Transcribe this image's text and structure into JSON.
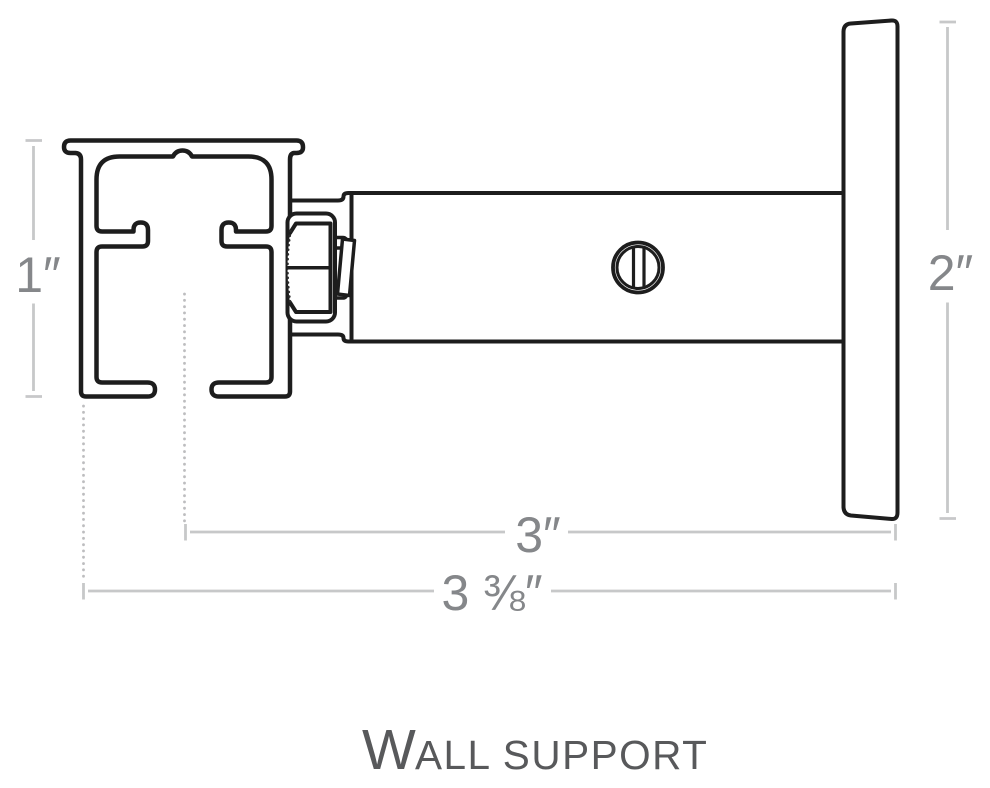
{
  "title": {
    "lead": "W",
    "rest": "ALL SUPPORT"
  },
  "dimensions": {
    "rail_height_label": "1″",
    "plate_height_label": "2″",
    "arm_projection_label": "3″",
    "overall_projection_label": "3 ⅜″"
  },
  "colors": {
    "outline": "#1d1d1d",
    "dimension_line": "#c7c8c9",
    "extension_line_dotted": "#bdbdbf",
    "dimension_text": "#85878a",
    "title_text": "#58595b",
    "background": "#ffffff"
  }
}
